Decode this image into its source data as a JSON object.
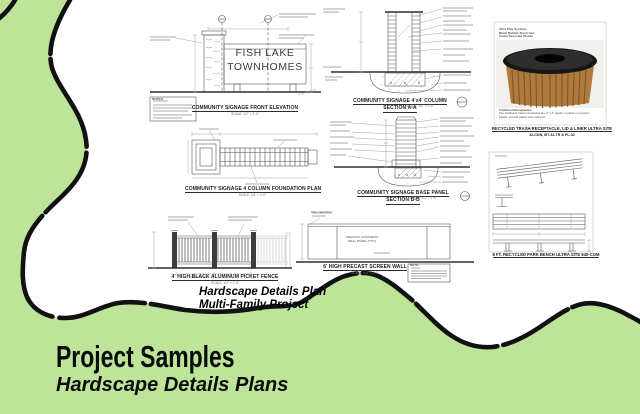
{
  "slide": {
    "footer_title": "Project Samples",
    "footer_subtitle": "Hardscape Details Plans",
    "blob_caption_line1": "Hardscape Details Plan",
    "blob_caption_line2": "Multi-Family Project"
  },
  "colors": {
    "background_green": "#bee49a",
    "blob_fill": "#ffffff",
    "blob_outline": "#111111",
    "wood_brown": "#b07a3e",
    "lid_black": "#161616"
  },
  "drawings": {
    "sign_elevation": {
      "sign_line1": "FISH LAKE",
      "sign_line2": "TOWNHOMES",
      "notes_label": "NOTES:",
      "caption": "COMMUNITY SIGNAGE FRONT ELEVATION",
      "scale_note": "SCALE: 1/2\" = 1'-0\""
    },
    "foundation_plan": {
      "caption": "COMMUNITY SIGNAGE 4 COLUMN FOUNDATION PLAN",
      "scale_note": "SCALE: 1/4\" = 1'-0\""
    },
    "column_section": {
      "caption_line1": "COMMUNITY SIGNAGE 4'x4' COLUMN",
      "caption_line2": "SECTION A-A",
      "scale_note": "SCALE: 1/2\" = 1'-0\""
    },
    "base_panel_section": {
      "caption_line1": "COMMUNITY SIGNAGE BASE PANEL",
      "caption_line2": "SECTION B-B",
      "scale_note": "SCALE: 1/2\" = 1'-0\""
    },
    "trash_receptacle": {
      "header_line1": "Ultra Play Systems",
      "header_line2": "Black Bubble Trash Can",
      "header_line3": "Cedar Recycled Plastic",
      "body_title": "Traditional Receptacles:",
      "body_text": "The traditional trash receptacles are 2\" x 4\" planks in panel or recycled plastic. Lid and plastic liner optional.",
      "caption_line1": "RECYCLED TRASH RECEPTACLE, LID & LINER ULTRA SITE",
      "caption_line2": "32-CDN, MT-32-TR & PL-32"
    },
    "park_bench": {
      "caption": "8 FT. RECYCLED PARK BENCH ULTRA SITE 940-COM"
    },
    "picket_fence": {
      "caption": "4' HIGH BLACK ALUMINUM PICKET FENCE",
      "scale_note": "SCALE: 1/2\" = 1'-0\""
    },
    "screen_wall": {
      "wall_section_label": "WALL SECTION",
      "panel_label_line1": "PRECAST CONCRETE",
      "panel_label_line2": "WALL PANEL (TYP.)",
      "note_label": "NOTE:",
      "caption": "6' HIGH PRECAST SCREEN WALL",
      "scale_note": "SCALE: 1/4\" = 1'-0\""
    }
  }
}
